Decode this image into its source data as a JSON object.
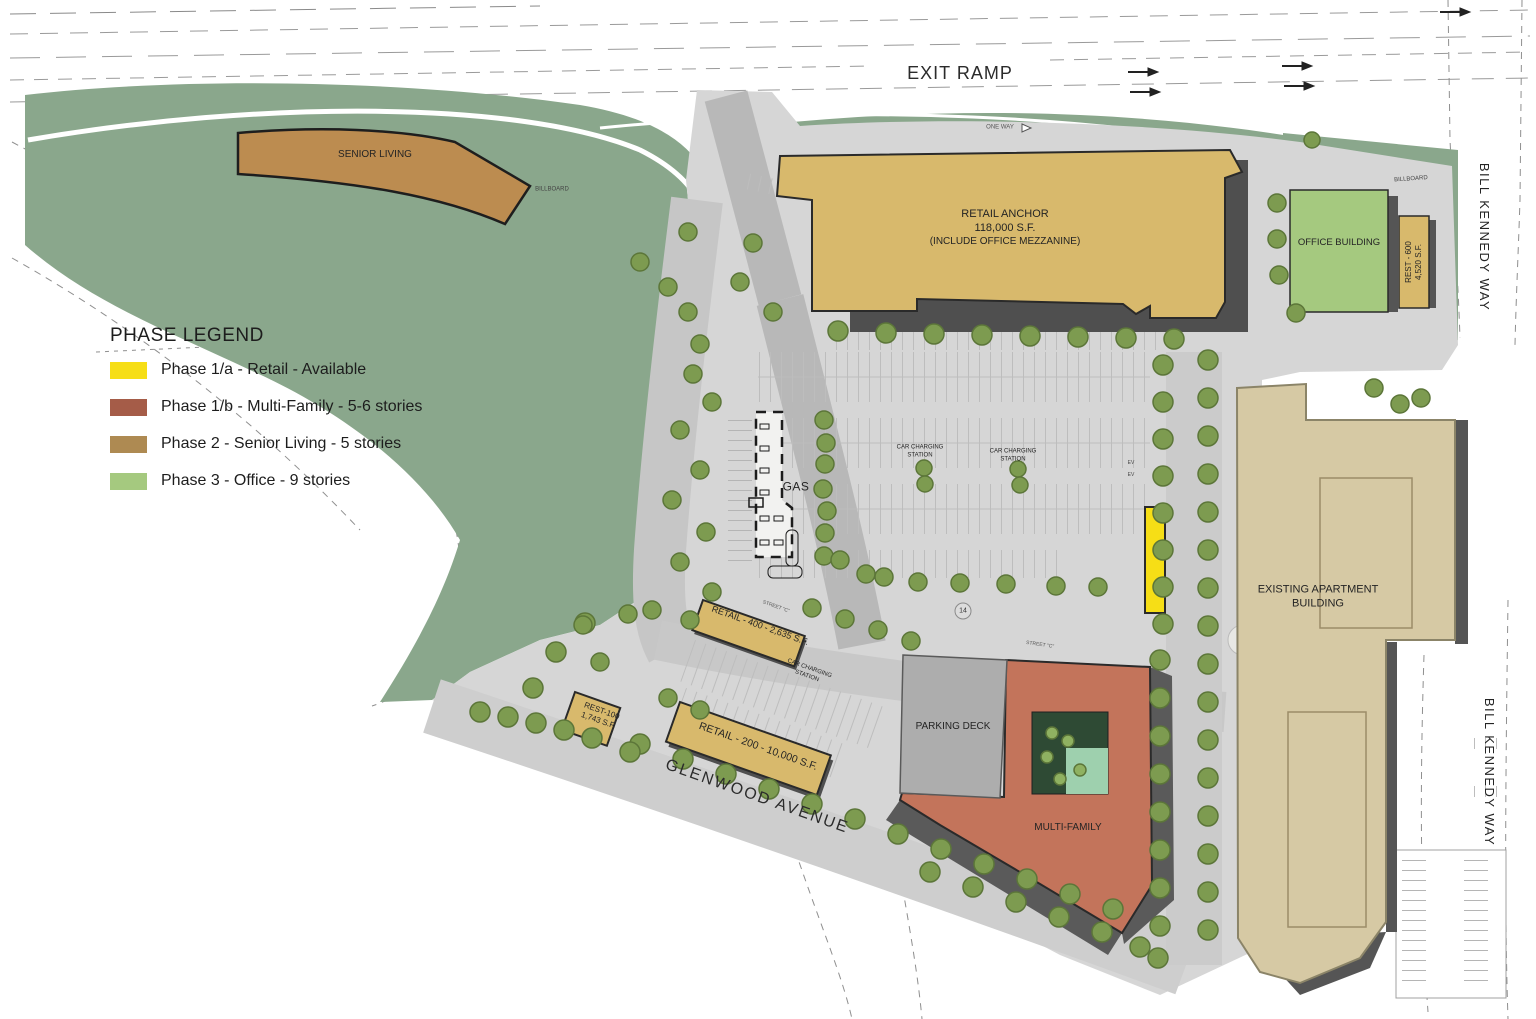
{
  "colors": {
    "phase_1a": "#F6DE16",
    "phase_1b": "#A55C48",
    "phase_2": "#AE8A52",
    "phase_3": "#A5C97F",
    "retail_tan": "#D8B96C",
    "senior_brown": "#BC8C50",
    "multi_red": "#C3745B",
    "office_green": "#A5C97F",
    "apartment_beige": "#D6C9A4",
    "landscape_green": "#8AA78C",
    "road_gray": "#D6D6D6",
    "deck_gray": "#ADADAD",
    "courtyard_green": "#2E4A34",
    "pool_green": "#9ED0AE",
    "available_yellow": "#F6DE16"
  },
  "legend": {
    "title": "PHASE LEGEND",
    "items": [
      {
        "label": "Phase 1/a - Retail - Available",
        "color": "#F6DE16"
      },
      {
        "label": "Phase 1/b - Multi-Family - 5-6 stories",
        "color": "#A55C48"
      },
      {
        "label": "Phase 2 - Senior Living - 5 stories",
        "color": "#AE8A52"
      },
      {
        "label": "Phase 3 - Office - 9 stories",
        "color": "#A5C97F"
      }
    ]
  },
  "roads": {
    "exit_ramp": "EXIT RAMP",
    "one_way": "ONE WAY",
    "glenwood": "GLENWOOD AVENUE",
    "bill_kennedy": "BILL KENNEDY WAY",
    "street_c": "STREET \"C\""
  },
  "buildings": {
    "senior_living": "SENIOR LIVING",
    "retail_anchor": {
      "name": "RETAIL ANCHOR",
      "area": "118,000 S.F.",
      "note": "(INCLUDE OFFICE MEZZANINE)"
    },
    "office": "OFFICE BUILDING",
    "rest_600": {
      "name": "REST - 600",
      "area": "4,520 S.F."
    },
    "retail_400": "RETAIL - 400 - 2,635 S.F.",
    "rest_100": {
      "name": "REST-100",
      "area": "1,743 S.F."
    },
    "retail_200": "RETAIL - 200 - 10,000 S.F.",
    "parking_deck": "PARKING DECK",
    "multi_family": "MULTI-FAMILY",
    "existing_apartment": {
      "line1": "EXISTING APARTMENT",
      "line2": "BUILDING"
    }
  },
  "labels": {
    "gas": "GAS",
    "billboard": "BILLBOARD",
    "car_charging_line1": "CAR CHARGING",
    "car_charging_line2": "STATION",
    "ev": "EV",
    "stall_count": "14"
  }
}
